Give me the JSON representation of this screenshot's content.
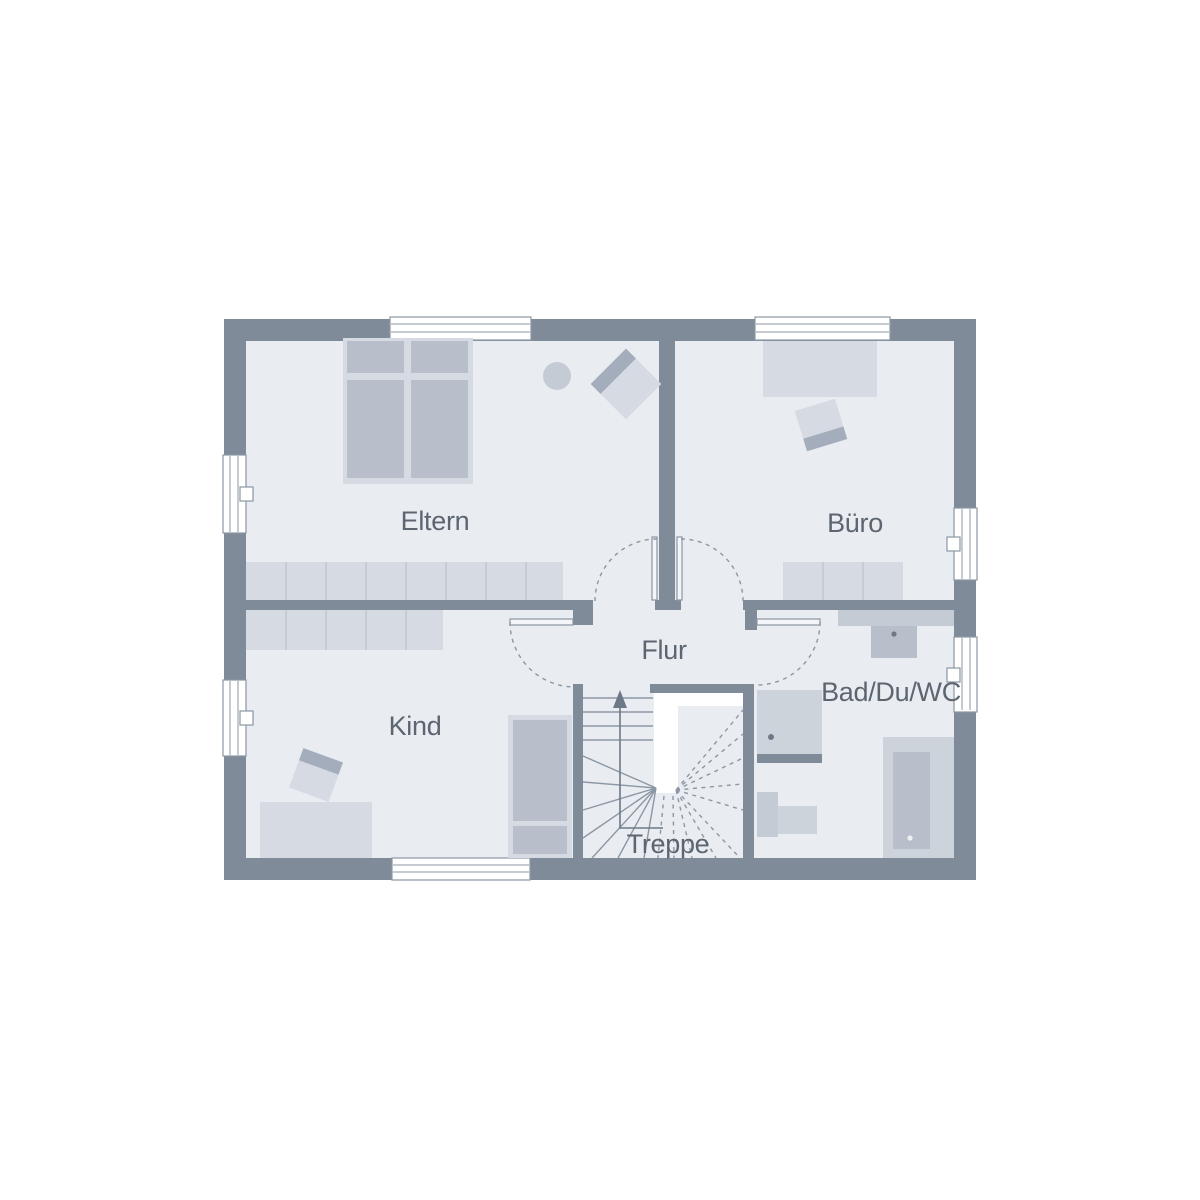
{
  "title": "Obergeschoss Grundriss",
  "rooms": {
    "eltern": {
      "label": "Eltern"
    },
    "buero": {
      "label": "Büro"
    },
    "flur": {
      "label": "Flur"
    },
    "kind": {
      "label": "Kind"
    },
    "bad": {
      "label": "Bad/Du/WC"
    },
    "treppe": {
      "label": "Treppe"
    }
  },
  "colors": {
    "wall": "#7f8b99",
    "floor": "#e9ecf1",
    "furnlight": "#d6dae2",
    "furnmid": "#b8bfca",
    "furndeep": "#a4adbb",
    "fixture": "#cdd3db",
    "fixture2": "#c5cbd5",
    "line": "#8c97a4",
    "divider": "#c0c6d0",
    "walk": "#6e7987",
    "text": "#5d6571"
  }
}
